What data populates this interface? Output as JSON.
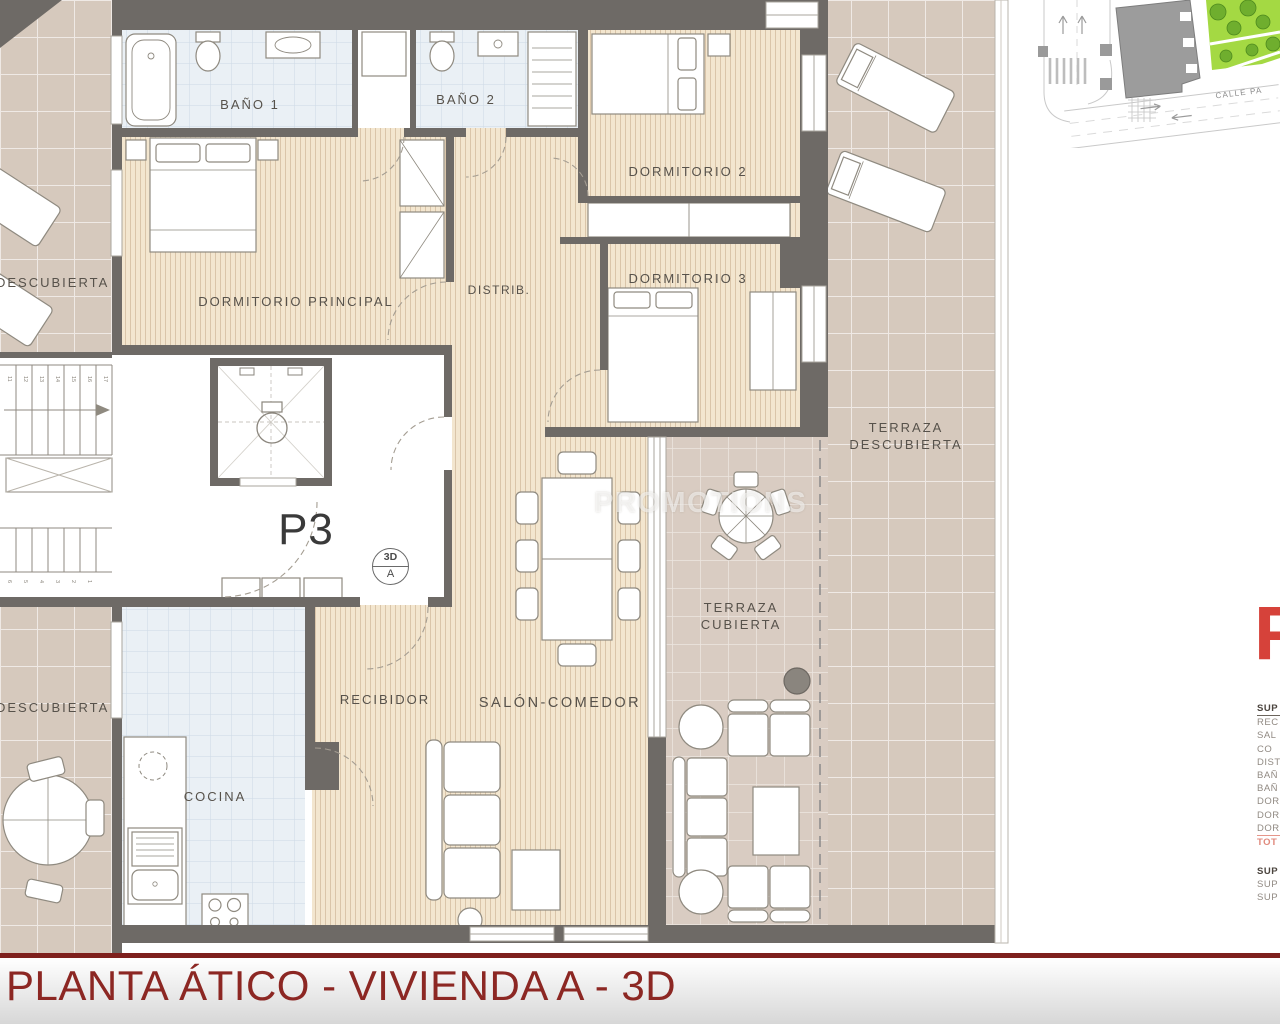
{
  "plan": {
    "unit_label": "P3",
    "symbol": {
      "top": "3D",
      "bottom": "A"
    },
    "labels": {
      "bano1": "BAÑO 1",
      "bano2": "BAÑO 2",
      "dormitorio2": "DORMITORIO 2",
      "dormitorio3": "DORMITORIO 3",
      "dormitorio_principal": "DORMITORIO PRINCIPAL",
      "distribuidor": "DISTRIB.",
      "recibidor": "RECIBIDOR",
      "salon_comedor": "SALÓN-COMEDOR",
      "cocina": "COCINA",
      "terraza_descubierta": {
        "line1": "TERRAZA",
        "line2": "DESCUBIERTA"
      },
      "terraza_cubierta": {
        "line1": "TERRAZA",
        "line2": "CUBIERTA"
      },
      "descubierta_left_top": "DESCUBIERTA",
      "descubierta_left_bottom": "DESCUBIERTA"
    },
    "stairs": {
      "upper": [
        "11",
        "12",
        "13",
        "14",
        "15",
        "16",
        "17"
      ],
      "lower": [
        "6",
        "5",
        "4",
        "3",
        "2",
        "1"
      ]
    }
  },
  "watermark": {
    "text": "PROMOTIONS"
  },
  "site_map": {
    "street_label": "CALLE PA"
  },
  "side_panel": {
    "big_letter": "F",
    "rows": [
      "SUP",
      "REC",
      "SAL",
      "CO",
      "DIST",
      "BAÑ",
      "BAÑ",
      "DOR",
      "DOR",
      "DOR",
      "TOT",
      "SUP",
      "SUP",
      "SUP"
    ]
  },
  "footer": {
    "title": "PLANTA ÁTICO - VIVIENDA A - 3D"
  },
  "colors": {
    "title_red": "#8c2723",
    "accent_red": "#d6423a",
    "salmon": "#e0897c",
    "wall": "#6e6a66",
    "terrace": "#d6c9bd",
    "wood": "#f3e6cf",
    "tile": "#eaf0f5"
  }
}
